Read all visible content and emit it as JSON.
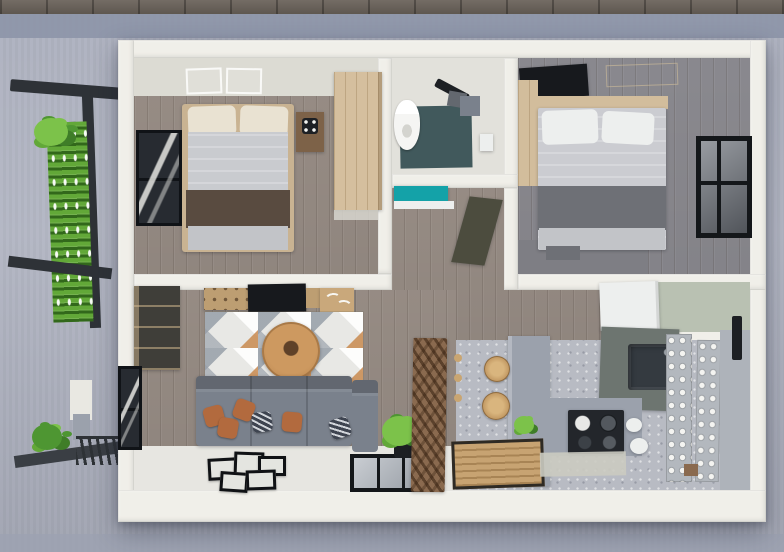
{
  "meta": {
    "title": "3D rendered top-down floor plan of a small two-bedroom house",
    "view": "top-down 3d render",
    "text_visible": "none"
  },
  "palette": {
    "paver": "#6b635b",
    "ground_band": "#8d95a9",
    "ground": "#adb1bf",
    "ground_dark": "#9ca1b1",
    "wall": "#f0efe9",
    "wall_shade": "#dcdbd3",
    "wood_floor": "#9c9189",
    "wood_floor_b2": "#8f8e94",
    "b2_shadow": "#7e7e84",
    "bed_frame": "#c9b392",
    "pillow_cream": "#e9e2d2",
    "duvet": "#c9cbcf",
    "runner_brown": "#594b40",
    "foot_gray": "#c2c4c8",
    "duvet2": "#cbccd1",
    "band2": "#6e7076",
    "wardrobe": "#d5bf9e",
    "nightstand": "#7d6248",
    "headboard": "#d2bd9c",
    "frame_dark": "#1d2024",
    "glass": "#63686f",
    "bath_floor": "#e2e1db",
    "shower_slate": "#41595c",
    "toilet": "#f5f5f3",
    "vanity_teal": "#14a2a8",
    "door_olive": "#4c4c3e",
    "cabinet_dark": "#6b5b4c",
    "console": "#bd9e72",
    "art_tan": "#c9a87b",
    "tv": "#17191d",
    "rug_base": "#e8e8e5",
    "rug_gray": "#b5bac1",
    "rug_orange": "#c8894f",
    "table_tan": "#cd9960",
    "sofa": "#7a818c",
    "sofa_dark": "#666d78",
    "pillow_orange": "#b26a3e",
    "pillow_navy": "#3e4450",
    "tile_white": "#e7e6e1",
    "kitchen_floor": "#b8bbc3",
    "mat_pale": "#cbcbc1",
    "counter": "#9ba1ac",
    "cab_sage_dark": "#6d7570",
    "sink": "#343a40",
    "stove": "#23262b",
    "fridge": "#edefee",
    "sage_wall": "#b9c1b2",
    "rack": "#b3b8be",
    "panel": "#aeb3ba",
    "handle": "#1c1f23",
    "stool": "#c9a571",
    "divider": "#8a6a4f",
    "mat_wood": "#c7a372",
    "pergola": "#2e3237",
    "green": "#62a838",
    "green_light": "#7cc24a",
    "green_dark": "#3f7d28",
    "shrub": "#4e9632",
    "walkway": "#3a3e44",
    "white_trim": "#e9e8e2"
  },
  "scene": {
    "exterior": {
      "ground": "concrete",
      "elements": [
        "paver-sidewalk",
        "pergola-frame",
        "vertical-garden-green-wall",
        "climbing-plant",
        "shrub",
        "planter",
        "walkway-slab",
        "drain-grate"
      ]
    },
    "rooms": [
      {
        "id": "bedroom-1",
        "label": "Bedroom 1",
        "objects": [
          "double-bed",
          "cream-pillows",
          "gray-duvet",
          "brown-bed-runner",
          "nightstand",
          "flower-decor",
          "wardrobe",
          "framed-window",
          "skylight-marks"
        ]
      },
      {
        "id": "bathroom",
        "label": "Bathroom",
        "objects": [
          "toilet",
          "shower-set",
          "slate-shower-floor",
          "storage-caddy",
          "toilet-paper-holder",
          "teal-vanity"
        ]
      },
      {
        "id": "hallway",
        "label": "Hallway",
        "objects": [
          "wood-plank-floor",
          "open-door"
        ]
      },
      {
        "id": "bedroom-2",
        "label": "Bedroom 2",
        "objects": [
          "double-bed",
          "white-pillows",
          "gray-duvet",
          "charcoal-foot-blanket",
          "wood-headboard",
          "tv-panel",
          "black-frame-window"
        ]
      },
      {
        "id": "living-room",
        "label": "Living Room",
        "objects": [
          "corner-sofa",
          "orange-throw-pillows",
          "navy-throw-pillows",
          "geometric-area-rug",
          "round-coffee-table",
          "media-console",
          "wall-tv",
          "bird-wall-art",
          "display-cabinet",
          "floor-picture-frames",
          "potted-plant",
          "framed-window",
          "floor-level-window"
        ]
      },
      {
        "id": "kitchen",
        "label": "Kitchen",
        "objects": [
          "l-shaped-counter",
          "gas-stove",
          "sink",
          "refrigerator",
          "sage-backsplash",
          "bar-stools",
          "wood-slat-divider",
          "wall-pegs",
          "wood-doormat",
          "dish-racks",
          "pantry-panel",
          "floor-mat",
          "counter-plant",
          "white-kettle"
        ]
      }
    ]
  }
}
